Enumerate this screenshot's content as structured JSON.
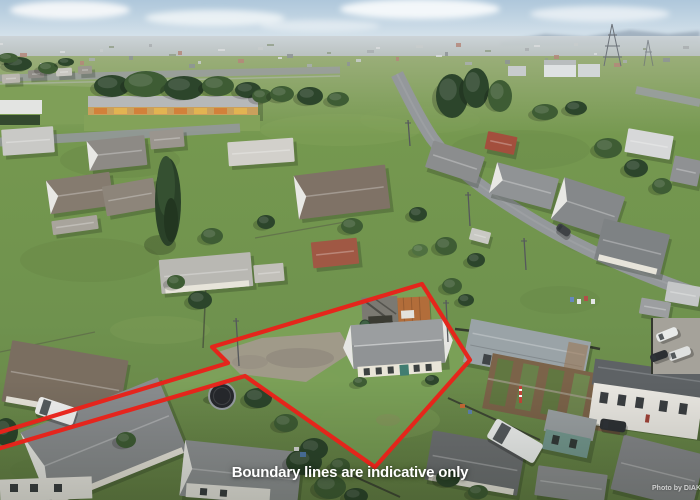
{
  "overlay": {
    "caption": "Boundary lines are indicative only",
    "watermark": "Photo by DIAKRIT",
    "boundary": {
      "color": "#e8221a",
      "points": "212,347 422,284 470,360 375,467 245,376 -6,450 -6,434 228,363"
    }
  },
  "palette": {
    "sky": "#b7cddf",
    "haze": "#c6ced3",
    "lawn": "#6f924e",
    "property_lawn": "#7ba157",
    "road": "#94989b",
    "roof_grey": "#8b8e90",
    "roof_red": "#a05844",
    "rust_roof": "#b26d3a",
    "gravel": "#a09a8d",
    "tree_dark": "#2c452b",
    "boundary_red": "#e8221a",
    "caption_text": "#ffffff"
  }
}
